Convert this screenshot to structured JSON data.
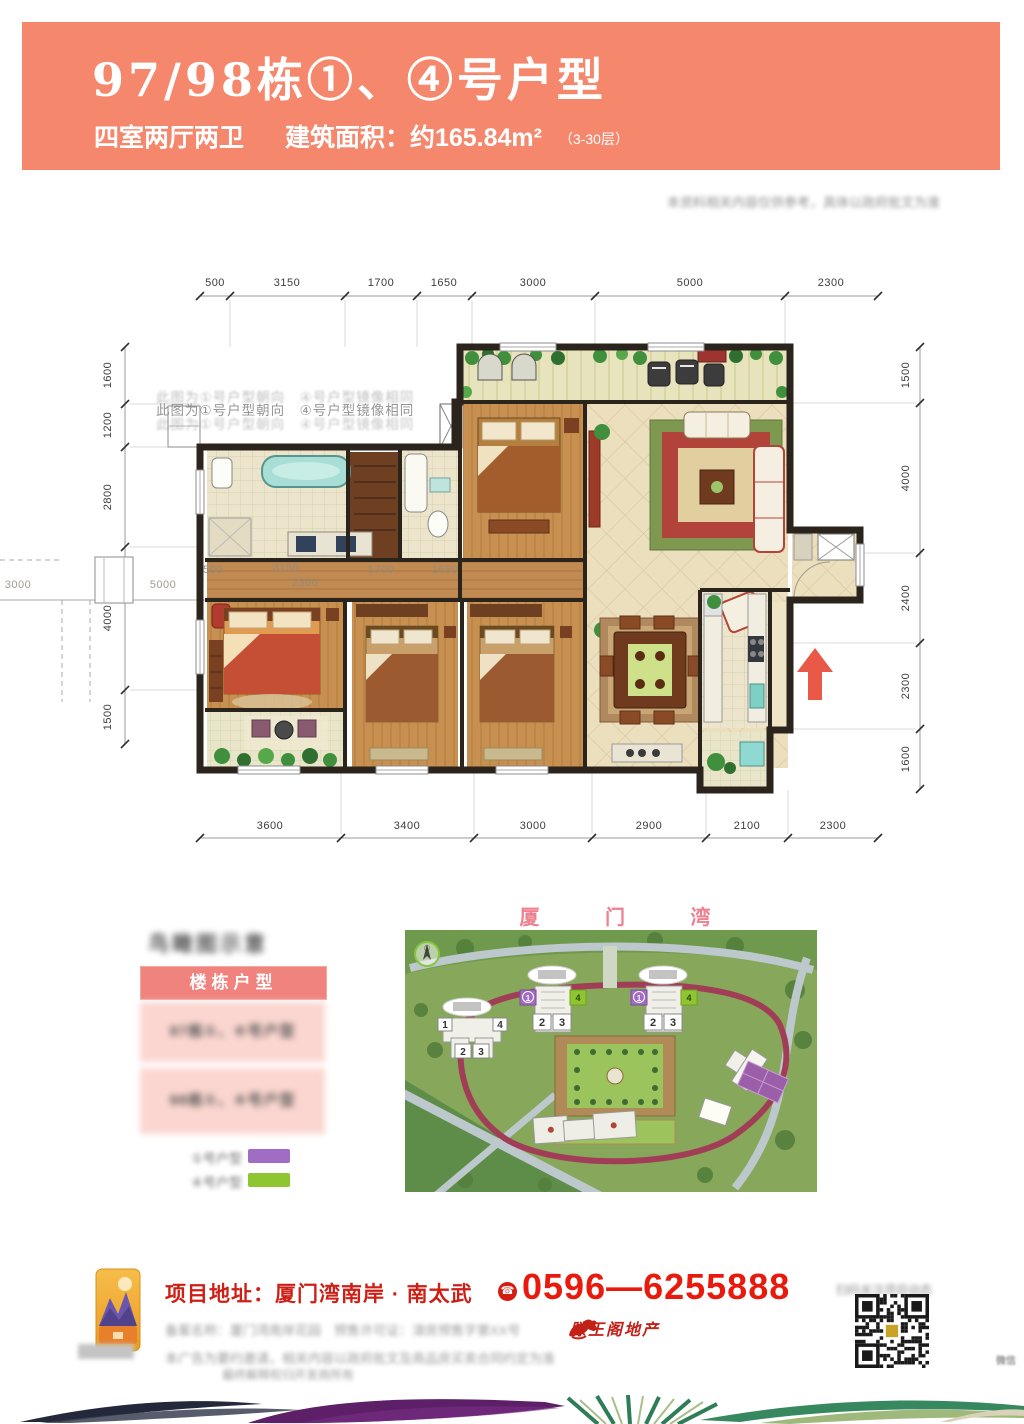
{
  "colors": {
    "header_bg": "#f5876c",
    "accent_red": "#d61c10",
    "table_header_pink": "#f0837d",
    "table_row_pink": "#fbd6d0",
    "legend_purple": "#a06cc4",
    "legend_green": "#8ec531"
  },
  "header": {
    "title": "97/98栋①、④号户型",
    "subtitle": "四室两厅两卫",
    "area_label": "建筑面积：约165.84m²",
    "floors_note": "（3-30层）"
  },
  "top_note_blurred": "本资料相关内容仅供参考，具体以政府批文为准",
  "plan": {
    "orientation_note": "此图为①号户型朝向　④号户型镜像相同",
    "dims_top": [
      "500",
      "3150",
      "1700",
      "1650",
      "3000",
      "5000",
      "2300"
    ],
    "dims_bottom": [
      "3600",
      "3400",
      "3000",
      "2900",
      "2100",
      "2300"
    ],
    "dims_left": [
      "1600",
      "1200",
      "2800",
      "4000",
      "1500"
    ],
    "dims_right": [
      "1500",
      "4000",
      "2400",
      "2300",
      "1600"
    ],
    "ghost_left": [
      "3000",
      "5000"
    ],
    "ghost_inner": [
      "500",
      "3150",
      "2300",
      "1700",
      "1650"
    ]
  },
  "sitemap": {
    "title": "厦 门 湾",
    "compass_label": "①",
    "unit_numbers": [
      "1",
      "4",
      "2",
      "3"
    ]
  },
  "legend": {
    "title_blurred": "鸟瞰图示意",
    "table_header": "楼栋户型",
    "row1_blurred": "97栋①、④号户型",
    "row2_blurred": "98栋①、④号户型",
    "item1_label_blurred": "①号户型",
    "item2_label_blurred": "④号户型"
  },
  "footer": {
    "address": "项目地址：厦门湾南岸 · 南太武",
    "phone_icon": "☎",
    "phone": "0596—6255888",
    "brand": "滕王阁地产",
    "line1_blurred": "备案名称：厦门湾南岸花园　预售许可证：漳房预售字第XX号",
    "line2_blurred": "本广告为要约邀请，相关内容以政府批文及商品房买卖合同约定为准",
    "line3_blurred": "最终解释权归开发商所有",
    "qr_caption_blurred": "扫码关注项目动态",
    "side_note_blurred": "微信"
  }
}
